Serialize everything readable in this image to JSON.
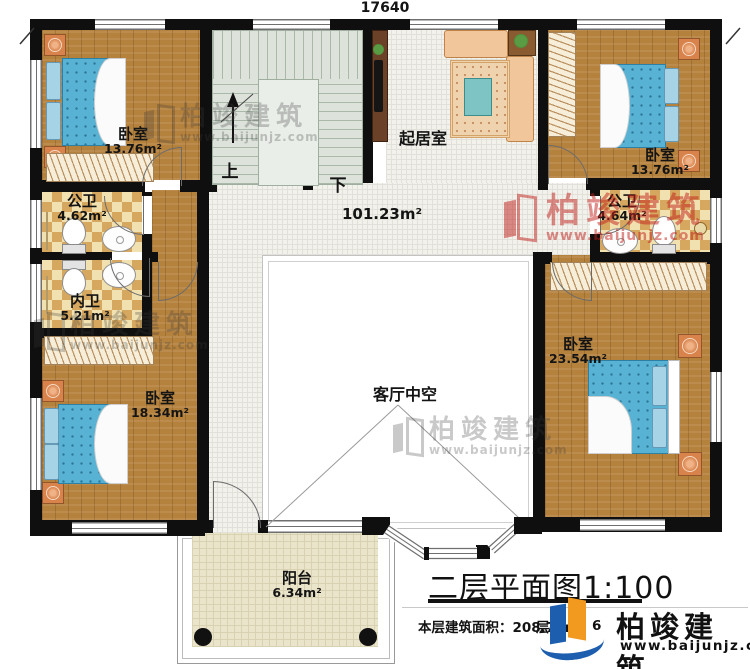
{
  "plan": {
    "dim_top": "17640",
    "dim_right": "15320",
    "hall_area": "101.23m²",
    "stairs_up": "上",
    "stairs_down": "下",
    "title": "二层平面图1:100",
    "floor_area_label": "本层建筑面积：",
    "floor_area_value": "208.77m²",
    "fragment_left": "层",
    "fragment_right": "6"
  },
  "rooms": {
    "bedroom_tl": {
      "name": "卧室",
      "area": "13.76m²"
    },
    "bedroom_tr": {
      "name": "卧室",
      "area": "13.76m²"
    },
    "bedroom_bl": {
      "name": "卧室",
      "area": "18.34m²"
    },
    "bedroom_br": {
      "name": "卧室",
      "area": "23.54m²"
    },
    "bath_left_public": {
      "name": "公卫",
      "area": "4.62m²"
    },
    "bath_inner": {
      "name": "内卫",
      "area": "5.21m²"
    },
    "bath_right_public": {
      "name": "公卫",
      "area": "4.64m²"
    },
    "living": {
      "name": "起居室"
    },
    "void": {
      "name": "客厅中空"
    },
    "balcony": {
      "name": "阳台",
      "area": "6.34m²"
    }
  },
  "watermark": {
    "brand": "柏竣建筑",
    "url": "www.baijunjz.com"
  },
  "footer": {
    "brand": "柏竣建筑",
    "url": "www.baijunjz.com"
  },
  "colors": {
    "wall": "#0f0f0f",
    "wood_floor": "#b5823e",
    "bath_tile": "#d6a75f",
    "hall_tile": "#f2f1ec",
    "stair_floor": "#dde3db",
    "balcony_tile": "#eae4cb",
    "mattress": "#57b2d4",
    "sofa": "#f2c69b",
    "watermark_red": "#c1201a",
    "logo_blue": "#1d5fae",
    "logo_orange": "#f29a1f"
  }
}
